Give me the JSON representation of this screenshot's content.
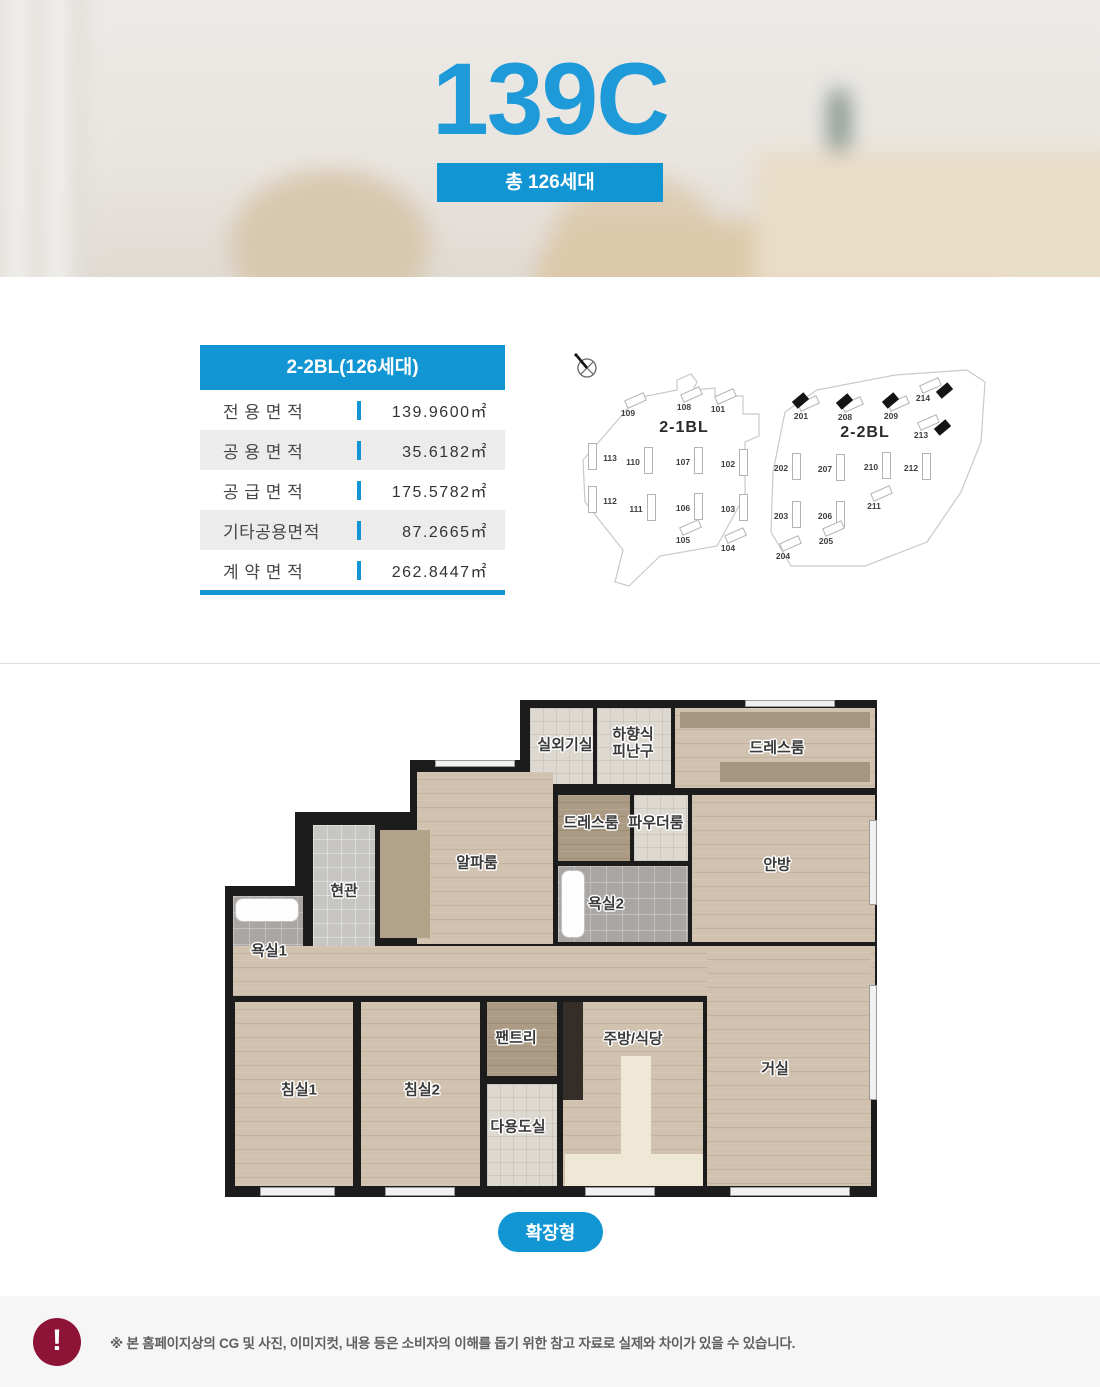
{
  "hero": {
    "title": "139C",
    "badge": "총 126세대"
  },
  "info_table": {
    "header": "2-2BL(126세대)",
    "rows": [
      {
        "label": "전 용 면 적",
        "value": "139.9600㎡"
      },
      {
        "label": "공 용 면 적",
        "value": "35.6182㎡"
      },
      {
        "label": "공 급 면 적",
        "value": "175.5782㎡"
      },
      {
        "label": "기타공용면적",
        "value": "87.2665㎡"
      },
      {
        "label": "계 약 면 적",
        "value": "262.8447㎡"
      }
    ]
  },
  "sitemap": {
    "compass_icon": "compass-north-icon",
    "blocks": [
      {
        "name": "2-1BL",
        "label_pos": {
          "x": 119,
          "y": 78
        },
        "buildings": [
          {
            "num": "109",
            "x": 63,
            "y": 63,
            "o": "h",
            "hl": false
          },
          {
            "num": "108",
            "x": 119,
            "y": 57,
            "o": "h",
            "hl": false
          },
          {
            "num": "101",
            "x": 153,
            "y": 59,
            "o": "h",
            "hl": false
          },
          {
            "num": "113",
            "x": 45,
            "y": 108,
            "o": "vl",
            "hl": false
          },
          {
            "num": "110",
            "x": 68,
            "y": 112,
            "o": "v",
            "hl": false
          },
          {
            "num": "107",
            "x": 118,
            "y": 112,
            "o": "v",
            "hl": false
          },
          {
            "num": "102",
            "x": 163,
            "y": 114,
            "o": "v",
            "hl": false
          },
          {
            "num": "112",
            "x": 45,
            "y": 151,
            "o": "vl",
            "hl": false
          },
          {
            "num": "111",
            "x": 71,
            "y": 159,
            "o": "v",
            "hl": false
          },
          {
            "num": "106",
            "x": 118,
            "y": 158,
            "o": "v",
            "hl": false
          },
          {
            "num": "103",
            "x": 163,
            "y": 159,
            "o": "v",
            "hl": false
          },
          {
            "num": "105",
            "x": 118,
            "y": 190,
            "o": "h",
            "hl": false
          },
          {
            "num": "104",
            "x": 163,
            "y": 198,
            "o": "h",
            "hl": false
          }
        ]
      },
      {
        "name": "2-2BL",
        "label_pos": {
          "x": 300,
          "y": 83
        },
        "buildings": [
          {
            "num": "201",
            "x": 236,
            "y": 66,
            "o": "h",
            "hl": true,
            "mx": -8,
            "my": -20
          },
          {
            "num": "208",
            "x": 280,
            "y": 67,
            "o": "h",
            "hl": true,
            "mx": -8,
            "my": -20
          },
          {
            "num": "209",
            "x": 326,
            "y": 66,
            "o": "h",
            "hl": true,
            "mx": -8,
            "my": -20
          },
          {
            "num": "214",
            "x": 358,
            "y": 48,
            "o": "h",
            "hl": true,
            "mx": 14,
            "my": -12
          },
          {
            "num": "213",
            "x": 356,
            "y": 85,
            "o": "h",
            "hl": true,
            "mx": 14,
            "my": -12
          },
          {
            "num": "202",
            "x": 216,
            "y": 118,
            "o": "v",
            "hl": false
          },
          {
            "num": "207",
            "x": 260,
            "y": 119,
            "o": "v",
            "hl": false
          },
          {
            "num": "210",
            "x": 306,
            "y": 117,
            "o": "v",
            "hl": false
          },
          {
            "num": "212",
            "x": 346,
            "y": 118,
            "o": "v",
            "hl": false
          },
          {
            "num": "203",
            "x": 216,
            "y": 166,
            "o": "v",
            "hl": false
          },
          {
            "num": "206",
            "x": 260,
            "y": 166,
            "o": "v",
            "hl": false
          },
          {
            "num": "211",
            "x": 309,
            "y": 156,
            "o": "h",
            "hl": false
          },
          {
            "num": "204",
            "x": 218,
            "y": 206,
            "o": "h",
            "hl": false
          },
          {
            "num": "205",
            "x": 261,
            "y": 191,
            "o": "h",
            "hl": false
          }
        ]
      }
    ]
  },
  "floorplan": {
    "button_label": "확장형",
    "rooms": [
      {
        "id": "outdoor-unit",
        "label": "실외기실",
        "x": 305,
        "y": 8,
        "w": 63,
        "h": 76,
        "floor": "tile-light",
        "lx": 340,
        "ly": 45
      },
      {
        "id": "escape-hatch",
        "label": "하향식\n피난구",
        "x": 372,
        "y": 8,
        "w": 74,
        "h": 76,
        "floor": "tile-light",
        "lx": 408,
        "ly": 43
      },
      {
        "id": "dressroom-master",
        "label": "드레스룸",
        "x": 450,
        "y": 8,
        "w": 200,
        "h": 80,
        "floor": "wood",
        "lx": 552,
        "ly": 48
      },
      {
        "id": "alpha-room",
        "label": "알파룸",
        "x": 192,
        "y": 72,
        "w": 136,
        "h": 172,
        "floor": "wood",
        "lx": 252,
        "ly": 163
      },
      {
        "id": "dressroom-2",
        "label": "드레스룸",
        "x": 333,
        "y": 95,
        "w": 72,
        "h": 66,
        "floor": "wood-dark",
        "lx": 366,
        "ly": 123
      },
      {
        "id": "powder-room",
        "label": "파우더룸",
        "x": 409,
        "y": 95,
        "w": 54,
        "h": 66,
        "floor": "tile-light",
        "lx": 431,
        "ly": 123
      },
      {
        "id": "master-bedroom",
        "label": "안방",
        "x": 467,
        "y": 95,
        "w": 183,
        "h": 147,
        "floor": "wood",
        "lx": 552,
        "ly": 165
      },
      {
        "id": "entrance",
        "label": "현관",
        "x": 88,
        "y": 125,
        "w": 62,
        "h": 130,
        "floor": "tile-gray",
        "lx": 119,
        "ly": 191
      },
      {
        "id": "bathroom-2",
        "label": "욕실2",
        "x": 333,
        "y": 166,
        "w": 130,
        "h": 76,
        "floor": "tile-bath",
        "lx": 381,
        "ly": 204
      },
      {
        "id": "bathroom-1",
        "label": "욕실1",
        "x": 8,
        "y": 196,
        "w": 70,
        "h": 100,
        "floor": "tile-bath",
        "lx": 44,
        "ly": 251
      },
      {
        "id": "corridor",
        "label": "",
        "x": 8,
        "y": 246,
        "w": 642,
        "h": 50,
        "floor": "wood"
      },
      {
        "id": "bedroom-1",
        "label": "침실1",
        "x": 10,
        "y": 302,
        "w": 118,
        "h": 184,
        "floor": "wood",
        "lx": 74,
        "ly": 390
      },
      {
        "id": "bedroom-2",
        "label": "침실2",
        "x": 136,
        "y": 302,
        "w": 119,
        "h": 184,
        "floor": "wood",
        "lx": 197,
        "ly": 390
      },
      {
        "id": "pantry",
        "label": "팬트리",
        "x": 262,
        "y": 302,
        "w": 70,
        "h": 74,
        "floor": "wood-dark",
        "lx": 291,
        "ly": 338
      },
      {
        "id": "utility-room",
        "label": "다용도실",
        "x": 262,
        "y": 384,
        "w": 70,
        "h": 102,
        "floor": "tile-light",
        "lx": 293,
        "ly": 427
      },
      {
        "id": "kitchen-dining",
        "label": "주방/식당",
        "x": 338,
        "y": 302,
        "w": 140,
        "h": 184,
        "floor": "wood",
        "lx": 408,
        "ly": 339
      },
      {
        "id": "living-room",
        "label": "거실",
        "x": 482,
        "y": 252,
        "w": 164,
        "h": 234,
        "floor": "wood",
        "lx": 550,
        "ly": 369
      }
    ]
  },
  "disclaimer": {
    "icon_glyph": "!",
    "text": "※ 본 홈페이지상의 CG 및 사진, 이미지컷, 내용 등은 소비자의 이해를 돕기 위한 참고 자료로 실제와 차이가 있을 수 있습니다."
  },
  "colors": {
    "accent": "#1195d3",
    "title_blue": "#1e9ad8",
    "alert": "#8e1437"
  }
}
